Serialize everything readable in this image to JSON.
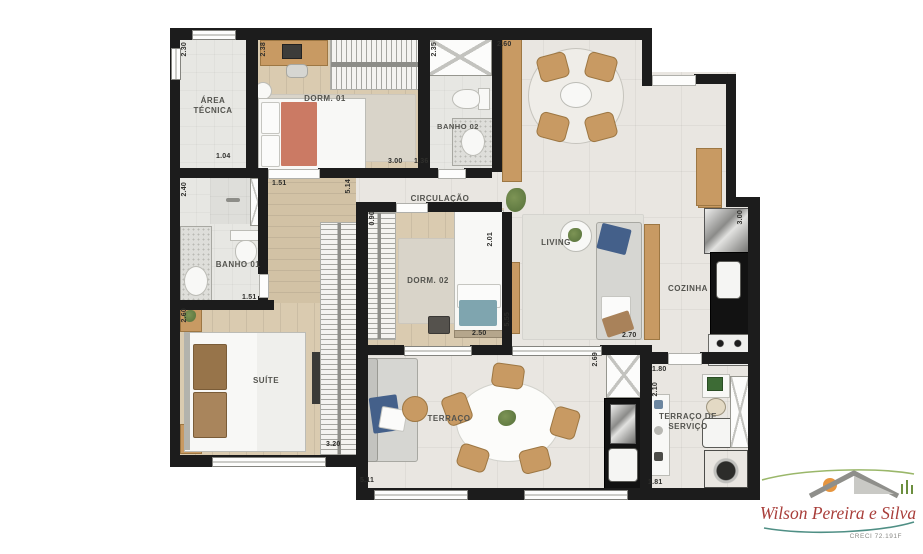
{
  "plan": {
    "rooms": {
      "area_tecnica": "ÁREA TÉCNICA",
      "dorm01": "DORM. 01",
      "banho02": "BANHO 02",
      "circulacao": "CIRCULAÇÃO",
      "banho01": "BANHO 01",
      "dorm02": "DORM. 02",
      "living": "LIVING",
      "cozinha": "COZINHA",
      "suite": "SUÍTE",
      "terraco": "TERRAÇO",
      "terraco_servico": "TERRAÇO DE SERVIÇO"
    },
    "dims": {
      "area_tecnica_h": "2.30",
      "area_tecnica_w": "1.04",
      "dorm01_h": "2.38",
      "dorm01_w": "3.00",
      "banho02_h": "2.35",
      "banho02_w": "1.36",
      "dining_w": "2.60",
      "banho01_h": "2.40",
      "hall_w_top": "1.51",
      "hall_len": "5.14",
      "circ_w": "0.90",
      "banho01_w": "1.51",
      "dorm02_h": "2.01",
      "dorm02_w": "2.50",
      "living_h": "5.55",
      "living_w": "2.70",
      "cozinha_h": "3.00",
      "suite_h": "2.60",
      "suite_w": "3.20",
      "terraco_w": "5.11",
      "terraco_h": "2.69",
      "servico_w_top": "1.80",
      "servico_h": "2.10",
      "servico_w_bottom": "1.81"
    }
  },
  "branding": {
    "name": "Wilson Pereira e Silva",
    "creci": "CRECI 72.191F"
  },
  "colors": {
    "wall": "#1c1c1c",
    "tile_floor": "#e9e6e1",
    "wood_floor": "#dacbb0",
    "furniture_wood": "#c89a63",
    "counter_black": "#121212",
    "pillow_blue": "#44608a",
    "pillow_teal": "#7fa5af",
    "throw_coral": "#cb7a64",
    "logo_red": "#a93e3a",
    "logo_green": "#7fae4a",
    "logo_teal": "#4f8f85",
    "logo_sun": "#e6953f"
  }
}
